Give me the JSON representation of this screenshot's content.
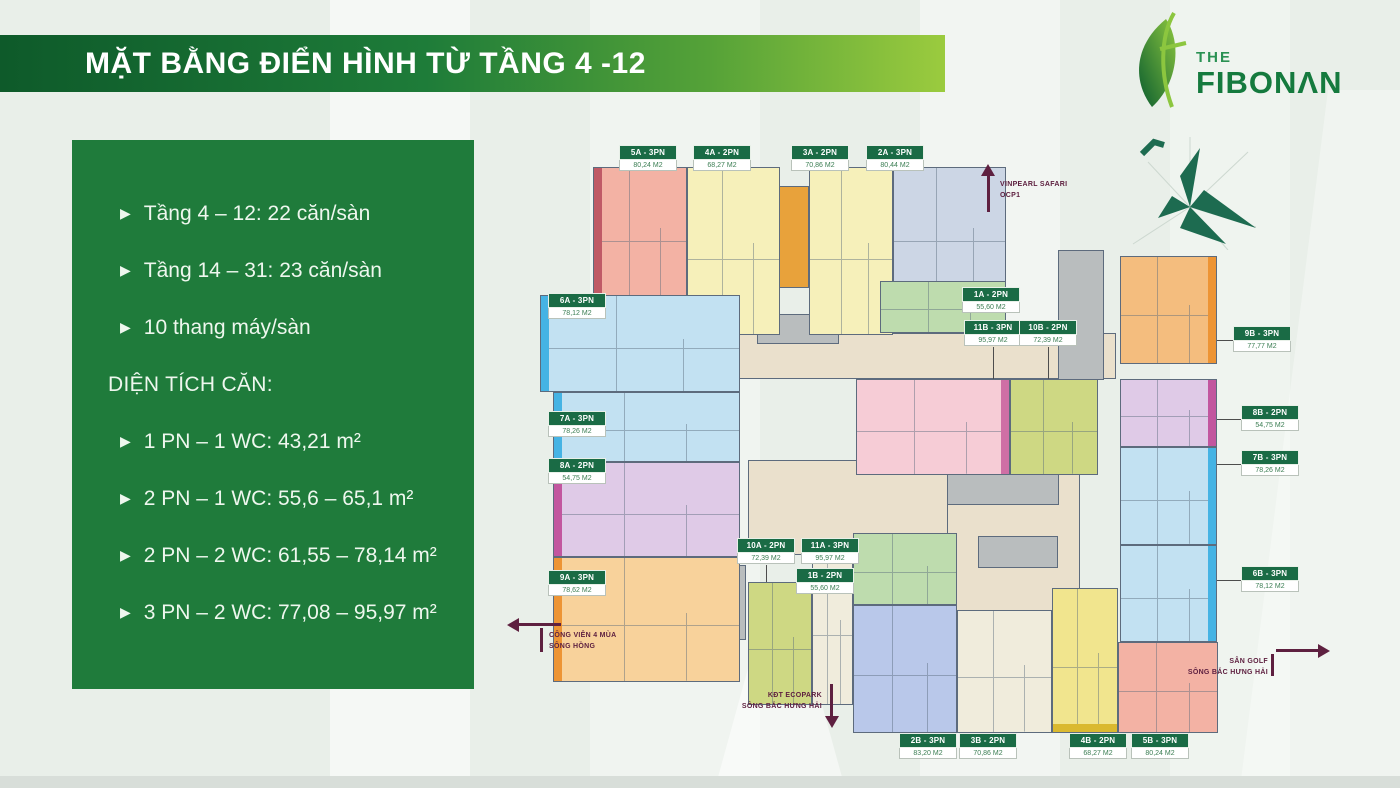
{
  "page": {
    "title": "MẶT BẰNG ĐIỂN HÌNH TỪ TẦNG 4 -12"
  },
  "logo": {
    "the": "THE",
    "name": "FIBONΛN"
  },
  "info_panel": {
    "bullets": [
      "Tầng 4 – 12: 22 căn/sàn",
      "Tầng 14 – 31: 23 căn/sàn",
      "10 thang máy/sàn"
    ],
    "heading": "DIỆN TÍCH CĂN:",
    "area_bullets": [
      "1 PN – 1 WC: 43,21 m²",
      "2 PN – 1 WC: 55,6 – 65,1 m²",
      "2 PN – 2 WC: 61,55 – 78,14 m²",
      "3 PN – 2 WC: 77,08 – 95,97 m²"
    ]
  },
  "directions": {
    "north": {
      "line1": "VINPEARL SAFARI",
      "line2": "OCP1"
    },
    "west": {
      "line1": "CÔNG VIÊN 4 MÙA",
      "line2": "SÔNG HỒNG"
    },
    "south": {
      "line1": "KĐT ECOPARK",
      "line2": "SÔNG BẮC HƯNG HẢI"
    },
    "east": {
      "line1": "SÂN GOLF",
      "line2": "SÔNG BẮC HƯNG HẢI"
    }
  },
  "units": {
    "1A": {
      "name": "1A - 2PN",
      "area": "55,60 M2"
    },
    "2A": {
      "name": "2A - 3PN",
      "area": "80,44 M2"
    },
    "3A": {
      "name": "3A - 2PN",
      "area": "70,86 M2"
    },
    "4A": {
      "name": "4A - 2PN",
      "area": "68,27 M2"
    },
    "5A": {
      "name": "5A - 3PN",
      "area": "80,24 M2"
    },
    "6A": {
      "name": "6A - 3PN",
      "area": "78,12 M2"
    },
    "7A": {
      "name": "7A - 3PN",
      "area": "78,26 M2"
    },
    "8A": {
      "name": "8A - 2PN",
      "area": "54,75 M2"
    },
    "9A": {
      "name": "9A - 3PN",
      "area": "78,62 M2"
    },
    "10A": {
      "name": "10A - 2PN",
      "area": "72,39 M2"
    },
    "11A": {
      "name": "11A - 3PN",
      "area": "95,97 M2"
    },
    "1B": {
      "name": "1B - 2PN",
      "area": "55,60 M2"
    },
    "2B": {
      "name": "2B - 3PN",
      "area": "83,20 M2"
    },
    "3B": {
      "name": "3B - 2PN",
      "area": "70,86 M2"
    },
    "4B": {
      "name": "4B - 2PN",
      "area": "68,27 M2"
    },
    "5B": {
      "name": "5B - 3PN",
      "area": "80,24 M2"
    },
    "6B": {
      "name": "6B - 3PN",
      "area": "78,12 M2"
    },
    "7B": {
      "name": "7B - 3PN",
      "area": "78,26 M2"
    },
    "8B": {
      "name": "8B - 2PN",
      "area": "54,75 M2"
    },
    "9B": {
      "name": "9B - 3PN",
      "area": "77,77 M2"
    },
    "10B": {
      "name": "10B - 2PN",
      "area": "72,39 M2"
    },
    "11B": {
      "name": "11B - 3PN",
      "area": "95,97 M2"
    }
  },
  "palette": {
    "brand_dark_green": "#0e5a2a",
    "brand_light_green": "#9bcb3e",
    "panel_green": "#1f7b3b",
    "label_green": "#1a6b45",
    "arrow_maroon": "#5e2040",
    "compass_green": "#1d6b50",
    "unit_colors": {
      "salmon": "#f3b2a4",
      "paleyellow": "#f6f0ba",
      "bluegray": "#ccd6e5",
      "lightblue": "#c2e1f2",
      "lavender": "#dfcae7",
      "peach": "#f8d29b",
      "green": "#bedcae",
      "pink": "#f6ccd6",
      "olive": "#ced883",
      "periwinkle": "#b9c8ea",
      "cream": "#f0ecdc",
      "yellow": "#f1e58e",
      "orange": "#f4bd7e",
      "corridor": "#eae0cc",
      "core": "#b9bdbe",
      "rose": "#c05a66",
      "sky": "#45b3e4",
      "magenta": "#c2569f",
      "orangedeep": "#ed9434",
      "magenta2": "#cf6fa5",
      "gold": "#dab92f",
      "orangecore": "#e8a23b"
    }
  }
}
